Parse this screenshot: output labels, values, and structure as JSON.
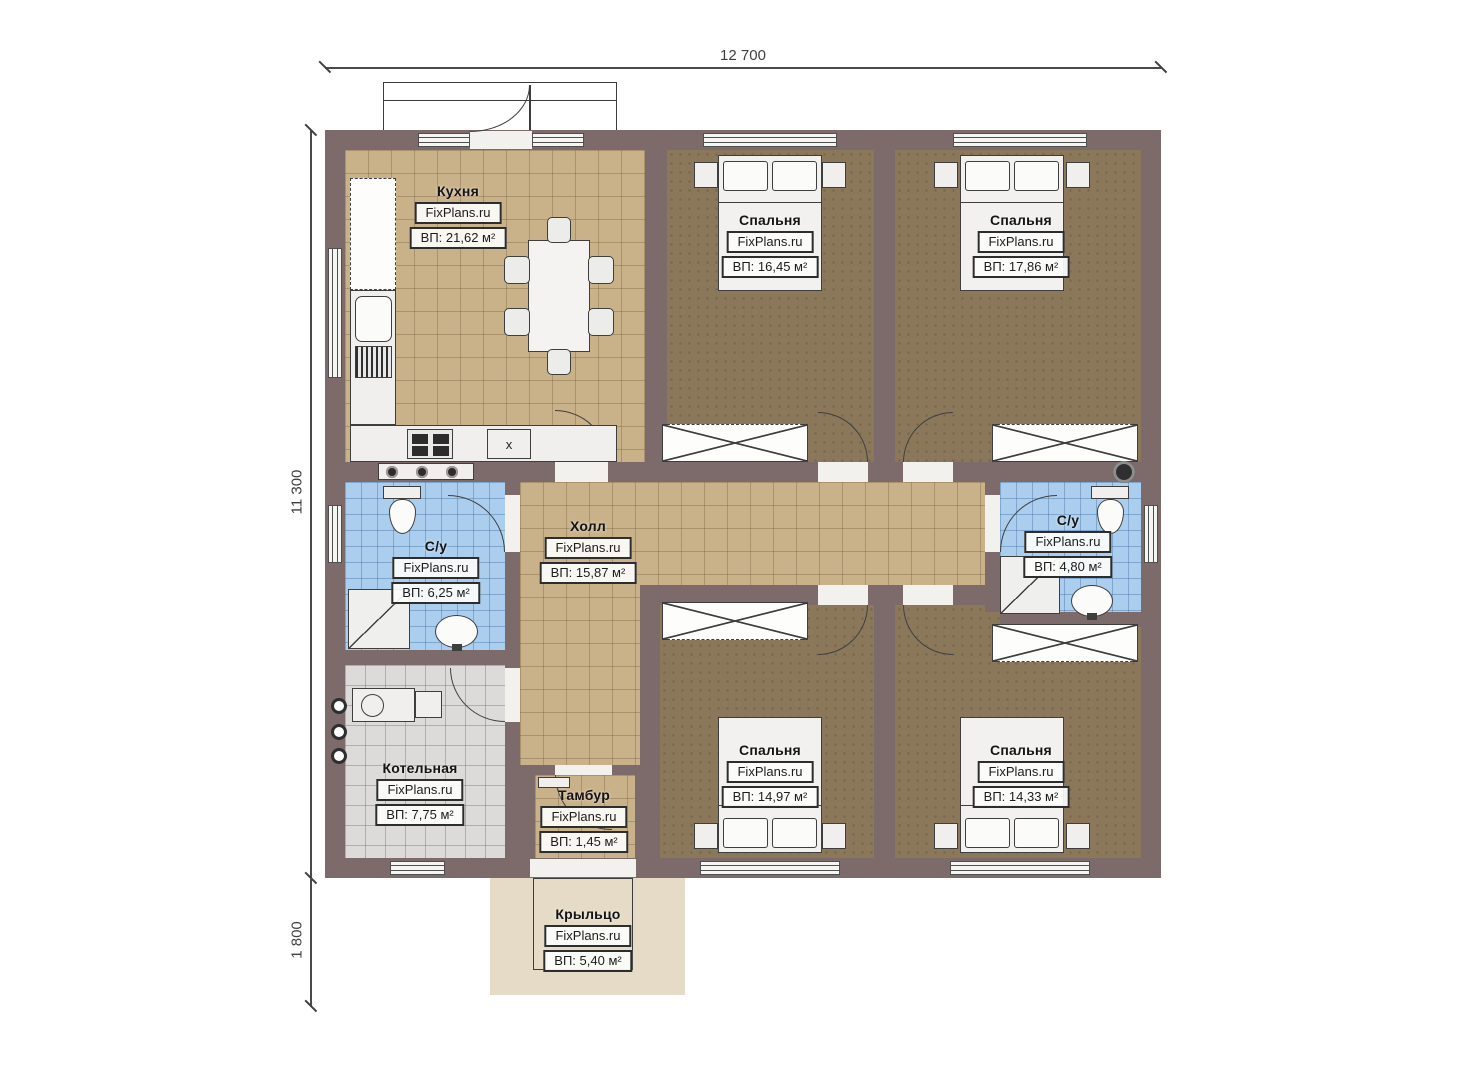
{
  "watermark": "FixPlans.ru",
  "dimensions": {
    "width_top": "12 700",
    "height_left": "11 300",
    "porch_height": "1 800"
  },
  "rooms": {
    "kitchen": {
      "name": "Кухня",
      "area": "ВП: 21,62 м²"
    },
    "bedroom_top_mid": {
      "name": "Спальня",
      "area": "ВП: 16,45 м²"
    },
    "bedroom_top_right": {
      "name": "Спальня",
      "area": "ВП: 17,86 м²"
    },
    "bathroom_left": {
      "name": "С/у",
      "area": "ВП: 6,25 м²"
    },
    "hall": {
      "name": "Холл",
      "area": "ВП: 15,87 м²"
    },
    "bathroom_right": {
      "name": "С/у",
      "area": "ВП: 4,80 м²"
    },
    "boiler_room": {
      "name": "Котельная",
      "area": "ВП: 7,75 м²"
    },
    "vestibule": {
      "name": "Тамбур",
      "area": "ВП: 1,45 м²"
    },
    "bedroom_bottom_mid": {
      "name": "Спальня",
      "area": "ВП: 14,97 м²"
    },
    "bedroom_bottom_right": {
      "name": "Спальня",
      "area": "ВП: 14,33 м²"
    },
    "porch": {
      "name": "Крыльцо",
      "area": "ВП: 5,40 м²"
    }
  },
  "kitchen_features": {
    "appliance_mark": "x"
  }
}
